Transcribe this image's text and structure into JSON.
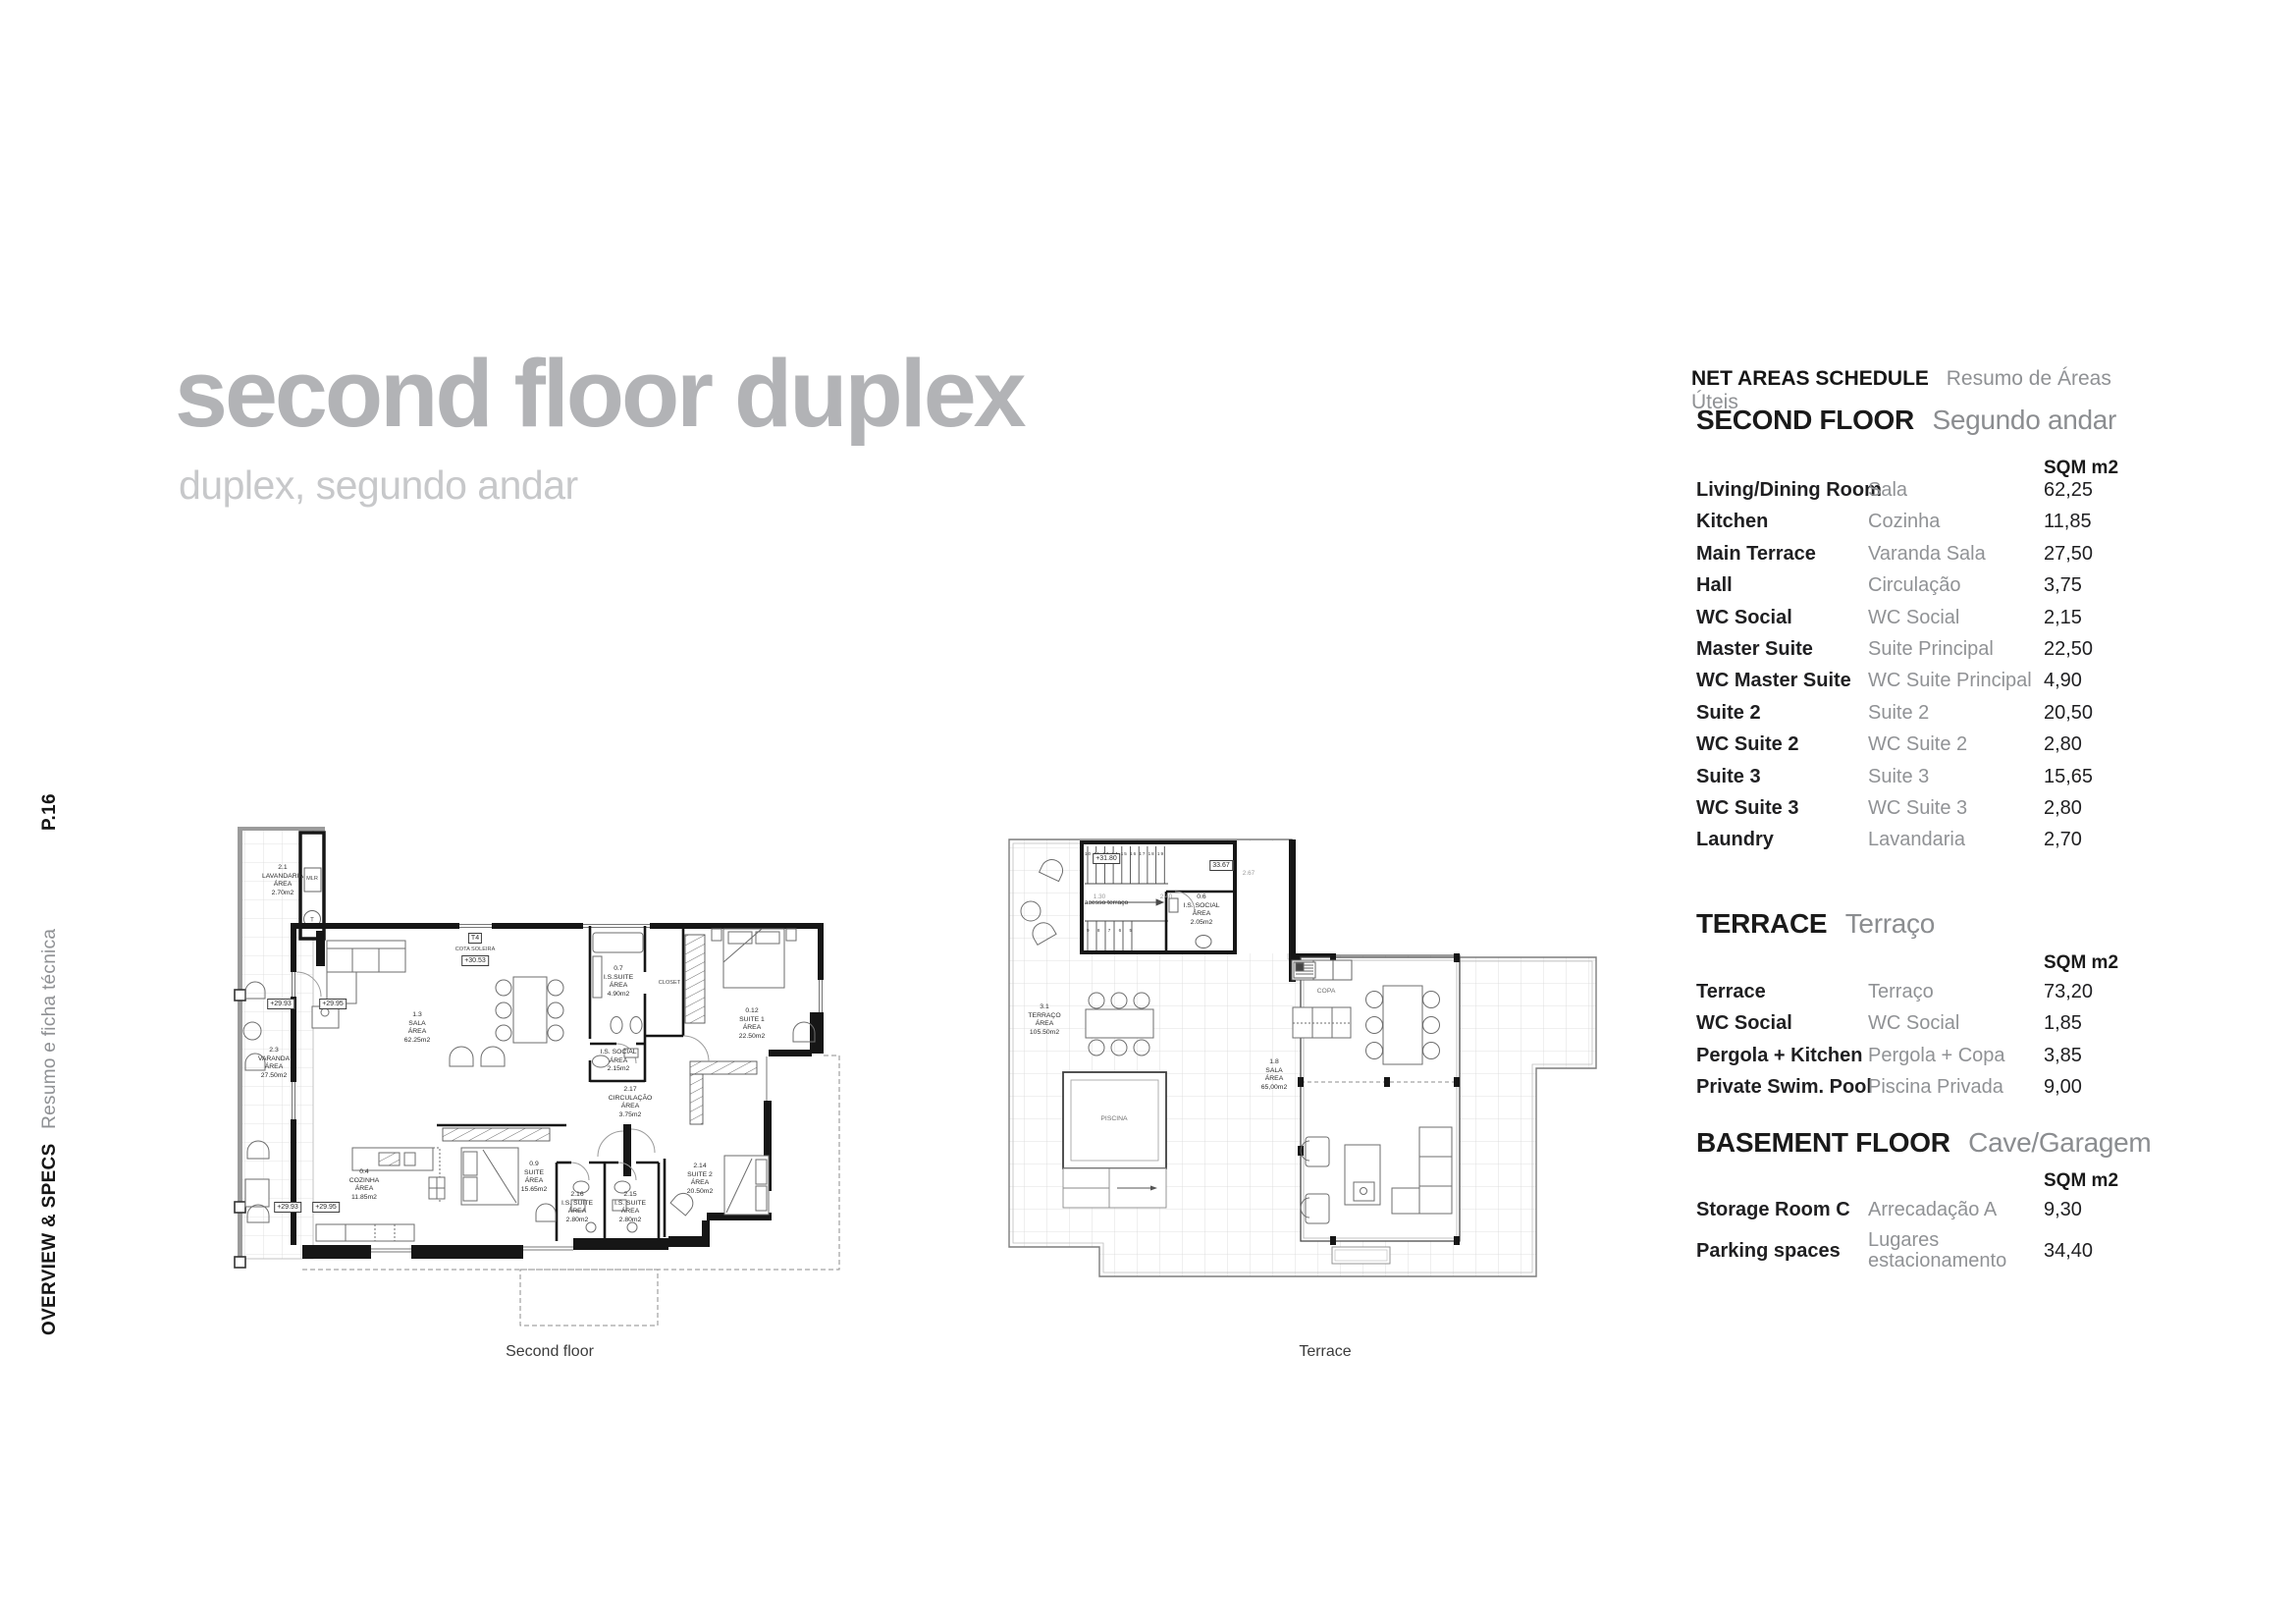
{
  "sidebar": {
    "page": "P.16",
    "section_en": "OVERVIEW & SPECS",
    "section_pt": "Resumo e ficha técnica"
  },
  "title": {
    "main": "second floor duplex",
    "subtitle": "duplex, segundo andar"
  },
  "schedule": {
    "title_en": "NET AREAS SCHEDULE",
    "title_pt": "Resumo de Áreas Úteis",
    "col_header": "SQM m2",
    "sections": [
      {
        "heading_en": "SECOND FLOOR",
        "heading_pt": "Segundo andar",
        "rows": [
          {
            "en": "Living/Dining Room",
            "pt": "Sala",
            "sqm": "62,25"
          },
          {
            "en": "Kitchen",
            "pt": "Cozinha",
            "sqm": "11,85"
          },
          {
            "en": "Main Terrace",
            "pt": "Varanda Sala",
            "sqm": "27,50"
          },
          {
            "en": "Hall",
            "pt": "Circulação",
            "sqm": "3,75"
          },
          {
            "en": "WC Social",
            "pt": "WC Social",
            "sqm": "2,15"
          },
          {
            "en": "Master Suite",
            "pt": "Suite Principal",
            "sqm": "22,50"
          },
          {
            "en": "WC Master Suite",
            "pt": "WC Suite Principal",
            "sqm": "4,90"
          },
          {
            "en": "Suite 2",
            "pt": "Suite 2",
            "sqm": "20,50"
          },
          {
            "en": "WC Suite 2",
            "pt": "WC Suite 2",
            "sqm": "2,80"
          },
          {
            "en": "Suite 3",
            "pt": "Suite 3",
            "sqm": "15,65"
          },
          {
            "en": "WC Suite 3",
            "pt": "WC Suite 3",
            "sqm": "2,80"
          },
          {
            "en": "Laundry",
            "pt": "Lavandaria",
            "sqm": "2,70"
          }
        ]
      },
      {
        "heading_en": "TERRACE",
        "heading_pt": "Terraço",
        "rows": [
          {
            "en": "Terrace",
            "pt": "Terraço",
            "sqm": "73,20"
          },
          {
            "en": "WC Social",
            "pt": "WC Social",
            "sqm": "1,85"
          },
          {
            "en": "Pergola + Kitchen",
            "pt": "Pergola + Copa",
            "sqm": "3,85"
          },
          {
            "en": "Private Swim. Pool",
            "pt": "Piscina Privada",
            "sqm": "9,00"
          }
        ]
      },
      {
        "heading_en": "BASEMENT FLOOR",
        "heading_pt": "Cave/Garagem",
        "rows": [
          {
            "en": "Storage Room C",
            "pt": "Arrecadação A",
            "sqm": "9,30"
          },
          {
            "en": "Parking spaces",
            "pt": "Lugares\nestacionamento",
            "sqm": "34,40"
          }
        ]
      }
    ]
  },
  "floorplans": {
    "second": {
      "caption": "Second floor",
      "labels": {
        "lavandaria": "2.1\nLAVANDARIA\nÁREA\n2.70m2",
        "varanda": "2.3\nVARANDA\nÁREA\n27.50m2",
        "sala": "1.3\nSALA\nÁREA\n62.25m2",
        "t4": "T4",
        "cota": "COTA SOLEIRA",
        "cota_val": "+30.53",
        "mlr": "MLR",
        "is_suite": "0.7\nI.S.SUITE\nÁREA\n4.90m2",
        "closet": "CLOSET",
        "suite1": "0.12\nSUITE 1\nÁREA\n22.50m2",
        "is_social": "I.S. SOCIAL\nÁREA\n2.15m2",
        "circulacao": "2.17\nCIRCULAÇÃO\nÁREA\n3.75m2",
        "cozinha": "0.4\nCOZINHA\nÁREA\n11.85m2",
        "suite09": "0.9\nSUITE\nÁREA\n15.65m2",
        "is216": "2.16\nI.S. SUITE\nÁREA\n2.80m2",
        "is215": "2.15\nI.S. SUITE\nÁREA\n2.80m2",
        "suite2": "2.14\nSUITE 2\nÁREA\n20.50m2",
        "lvl_a1": "+29.93",
        "lvl_a2": "+29.95",
        "lvl_b1": "+29.93",
        "lvl_b2": "+29.95"
      }
    },
    "terrace": {
      "caption": "Terrace",
      "labels": {
        "lvl": "+31.80",
        "cota": "33.67",
        "dim1": "1.30",
        "dim2": "2.40",
        "dim3": "2.67",
        "acesso": "acesso terraço",
        "wc": "0.6\nI.S. SOCIAL\nÁREA\n2.05m2",
        "terraco": "3.1\nTERRAÇO\nÁREA\n105.50m2",
        "piscina": "PISCINA",
        "sala": "1.8\nSALA\nÁREA\n65,00m2",
        "copa": "COPA"
      },
      "stairs_top": "10 11 13 14 15 16 17 18 19",
      "stairs_bottom": "9 8 7 6 5"
    }
  }
}
